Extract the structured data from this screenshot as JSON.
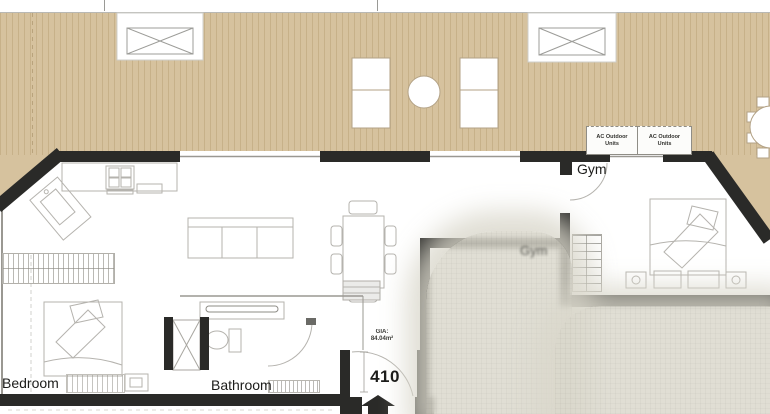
{
  "labels": {
    "bedroom": "Bedroom",
    "bathroom": "Bathroom",
    "gym": "Gym",
    "gym_inner": "Gym",
    "unit_number": "410",
    "gia_line1": "GIA:",
    "gia_line2": "84.04m²"
  },
  "ac_units": [
    {
      "line1": "AC Outdoor",
      "line2": "Units"
    },
    {
      "line1": "AC Outdoor",
      "line2": "Units"
    }
  ],
  "colors": {
    "deck": "#d6c29e",
    "deck_plank_line": "#c7b189",
    "wall": "#2a2a28",
    "furniture_line": "#b5b3ae",
    "blur_patch": "#d9d7cb"
  }
}
